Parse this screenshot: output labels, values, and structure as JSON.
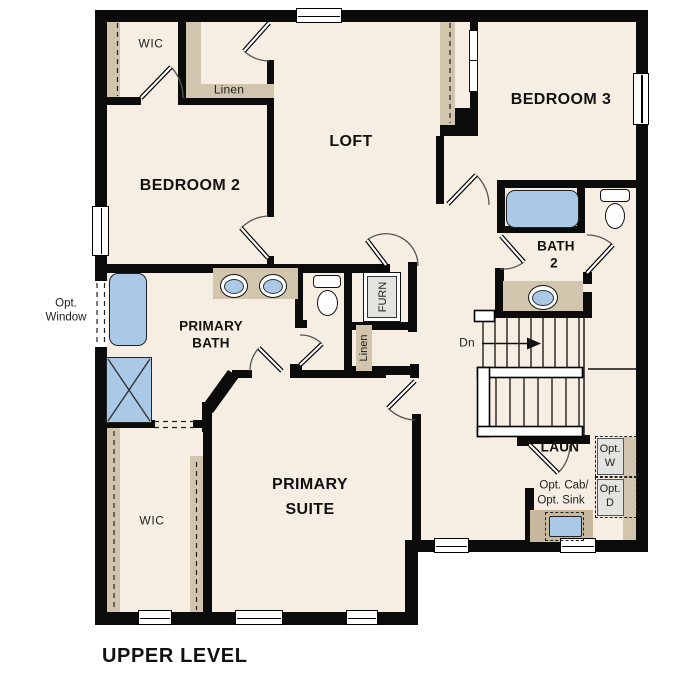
{
  "title": "UPPER LEVEL",
  "labels": {
    "wic_top": "WIC",
    "linen_top": "Linen",
    "bedroom2": "BEDROOM 2",
    "loft": "LOFT",
    "bedroom3": "BEDROOM 3",
    "bath2_l1": "BATH",
    "bath2_l2": "2",
    "primary_bath_l1": "PRIMARY",
    "primary_bath_l2": "BATH",
    "primary_suite_l1": "PRIMARY",
    "primary_suite_l2": "SUITE",
    "furn": "FURN",
    "linen_mid": "Linen",
    "dn": "Dn",
    "laun": "LAUN",
    "opt_w_l1": "Opt.",
    "opt_w_l2": "W",
    "opt_d_l1": "Opt.",
    "opt_d_l2": "D",
    "opt_cab": "Opt. Cab/",
    "opt_sink": "Opt. Sink",
    "opt_window_l1": "Opt.",
    "opt_window_l2": "Window",
    "wic_bottom": "WIC"
  },
  "colors": {
    "floor": "#F6EEE2",
    "wall": "#0B0B0B",
    "tan": "#D2C5AE",
    "tanDark": "#C7B89E",
    "blue": "#A9C9E7",
    "gray": "#E3E3E0"
  }
}
